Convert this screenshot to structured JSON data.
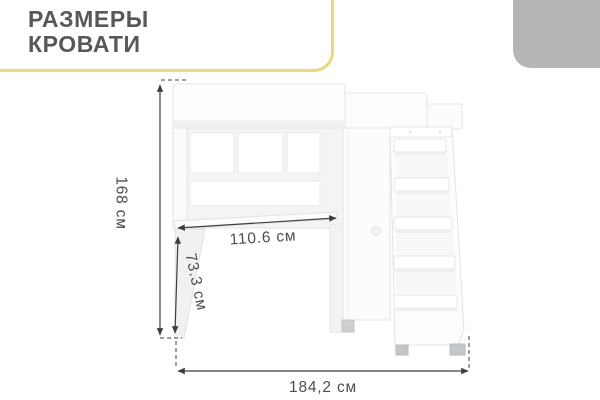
{
  "title": {
    "line1": "РАЗМЕРЫ",
    "line2": "КРОВАТИ"
  },
  "dimensions": {
    "height": "168 см",
    "desk_width": "110.6 см",
    "desk_height": "73.3 см",
    "total_width": "184,2 см"
  },
  "colors": {
    "accent_yellow": "#ecd87c",
    "corner_gray": "#b4b5b6",
    "title_text": "#57585a",
    "dimension_text": "#4c4d4f",
    "dimension_line": "#3d3e40",
    "furniture_outline": "#e2e4e6",
    "furniture_shade": "#f2f3f5",
    "feet_gray": "#c3c7c9"
  }
}
